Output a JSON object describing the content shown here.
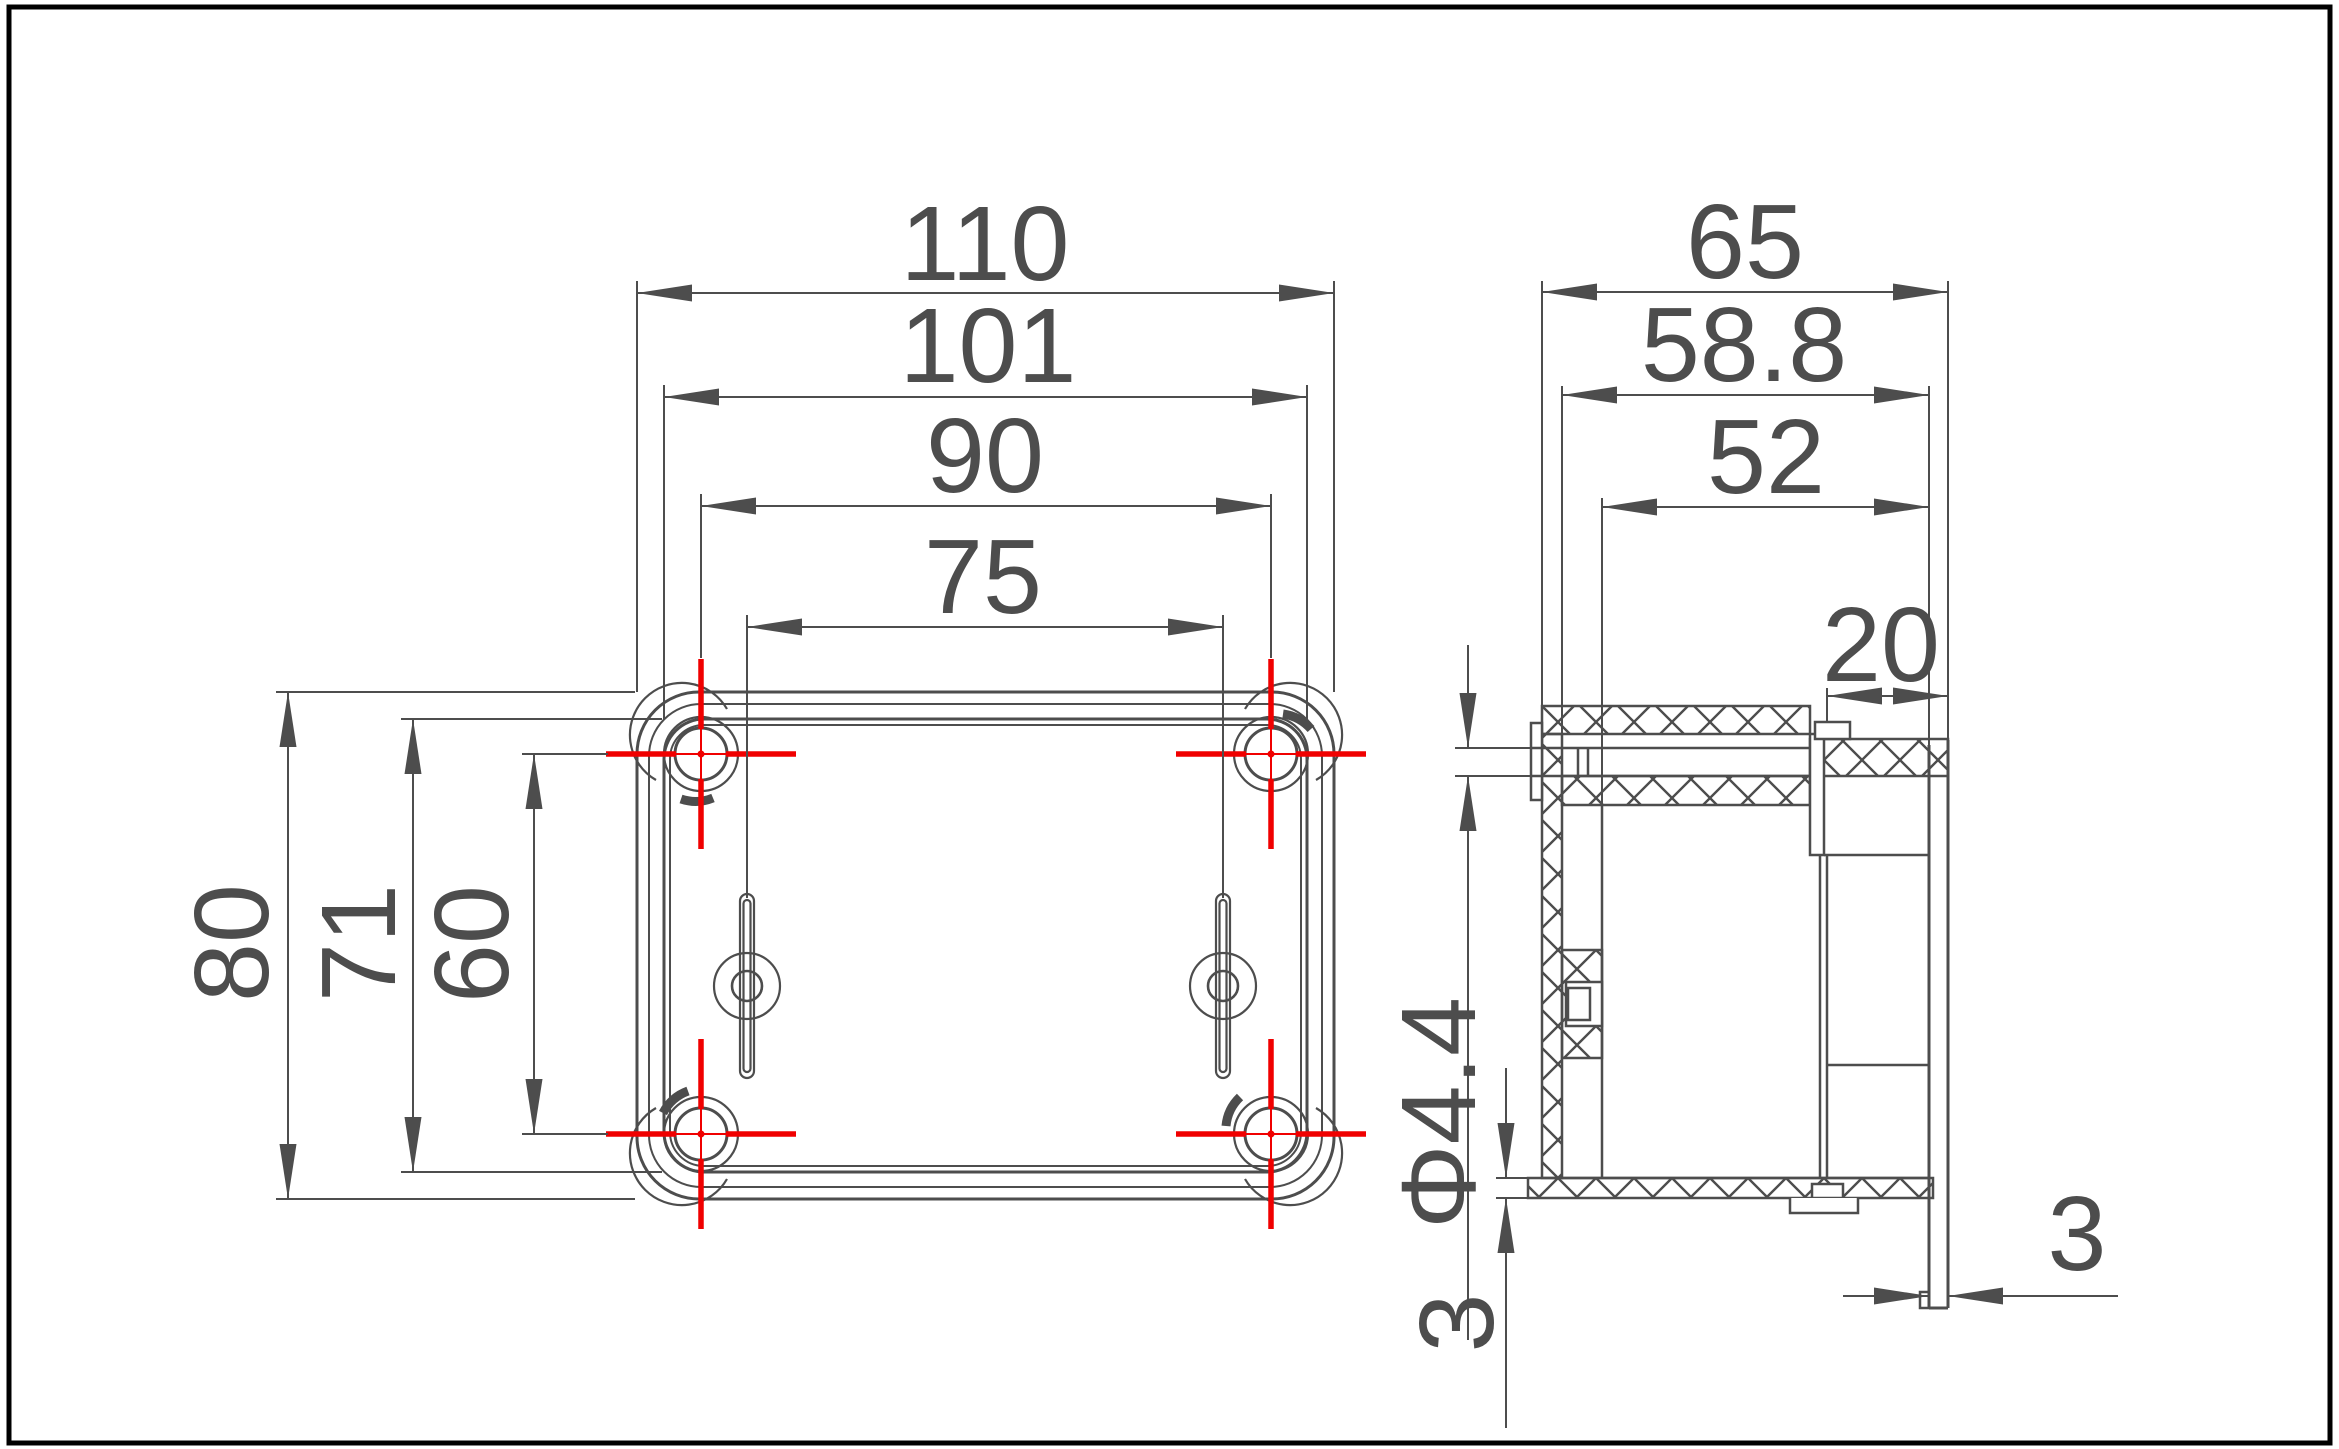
{
  "drawing": {
    "title": "enclosure-dimension-drawing",
    "views": {
      "plan_view_name": "bottom-plan-view",
      "section_view_name": "side-section-view"
    },
    "dimensions": {
      "plan": {
        "overall_width": "110",
        "inner_width": "101",
        "hole_spacing_h": "90",
        "keyhole_spacing": "75",
        "overall_height": "80",
        "inner_height": "71",
        "hole_spacing_v": "60"
      },
      "section": {
        "overall_depth": "65",
        "inner_depth_outer": "58.8",
        "inner_depth": "52",
        "lid_overlap": "20",
        "screw_hole_diameter": "Φ4.4",
        "bottom_wall_thickness": "3",
        "lid_thickness": "3"
      }
    },
    "colors": {
      "line": "#4d4d4d",
      "center_mark": "#f00000",
      "border": "#000000",
      "background": "#ffffff"
    }
  }
}
